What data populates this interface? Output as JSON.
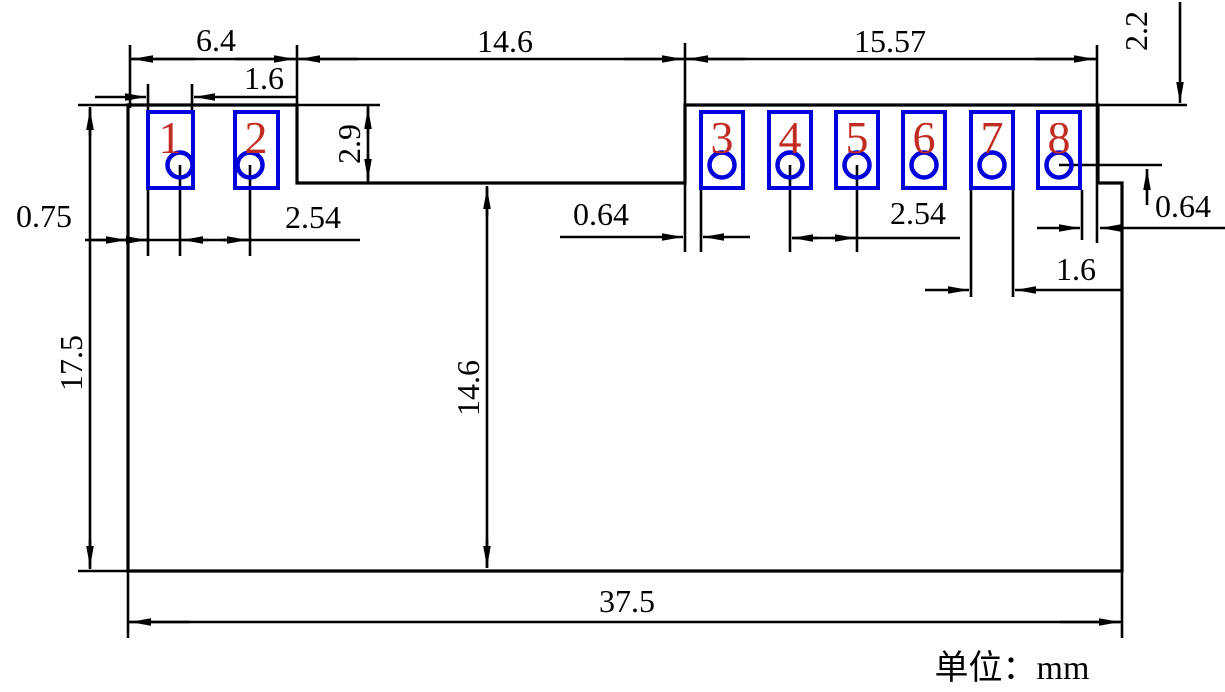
{
  "title": "PCB module footprint dimension drawing",
  "unit_label": "单位：mm",
  "colors": {
    "line": "#000000",
    "pad": "#0000dd",
    "pad-number": "#c22b22"
  },
  "pads": [
    {
      "label": "1"
    },
    {
      "label": "2"
    },
    {
      "label": "3"
    },
    {
      "label": "4"
    },
    {
      "label": "5"
    },
    {
      "label": "6"
    },
    {
      "label": "7"
    },
    {
      "label": "8"
    }
  ],
  "dimensions": {
    "left_section_width": "6.4",
    "pad1_width": "1.6",
    "notch_width": "14.6",
    "right_section_width": "15.57",
    "top_edge_to_hole_row": "2.2",
    "notch_depth": "2.9",
    "left_edge_to_pad1": "0.75",
    "hole_pitch_left": "2.54",
    "edge_to_pad3_gap": "0.64",
    "hole_pitch_right": "2.54",
    "pad8_to_edge_gap": "0.64",
    "pad7_width": "1.6",
    "board_height": "17.5",
    "notch_to_bottom": "14.6",
    "board_width": "37.5"
  }
}
